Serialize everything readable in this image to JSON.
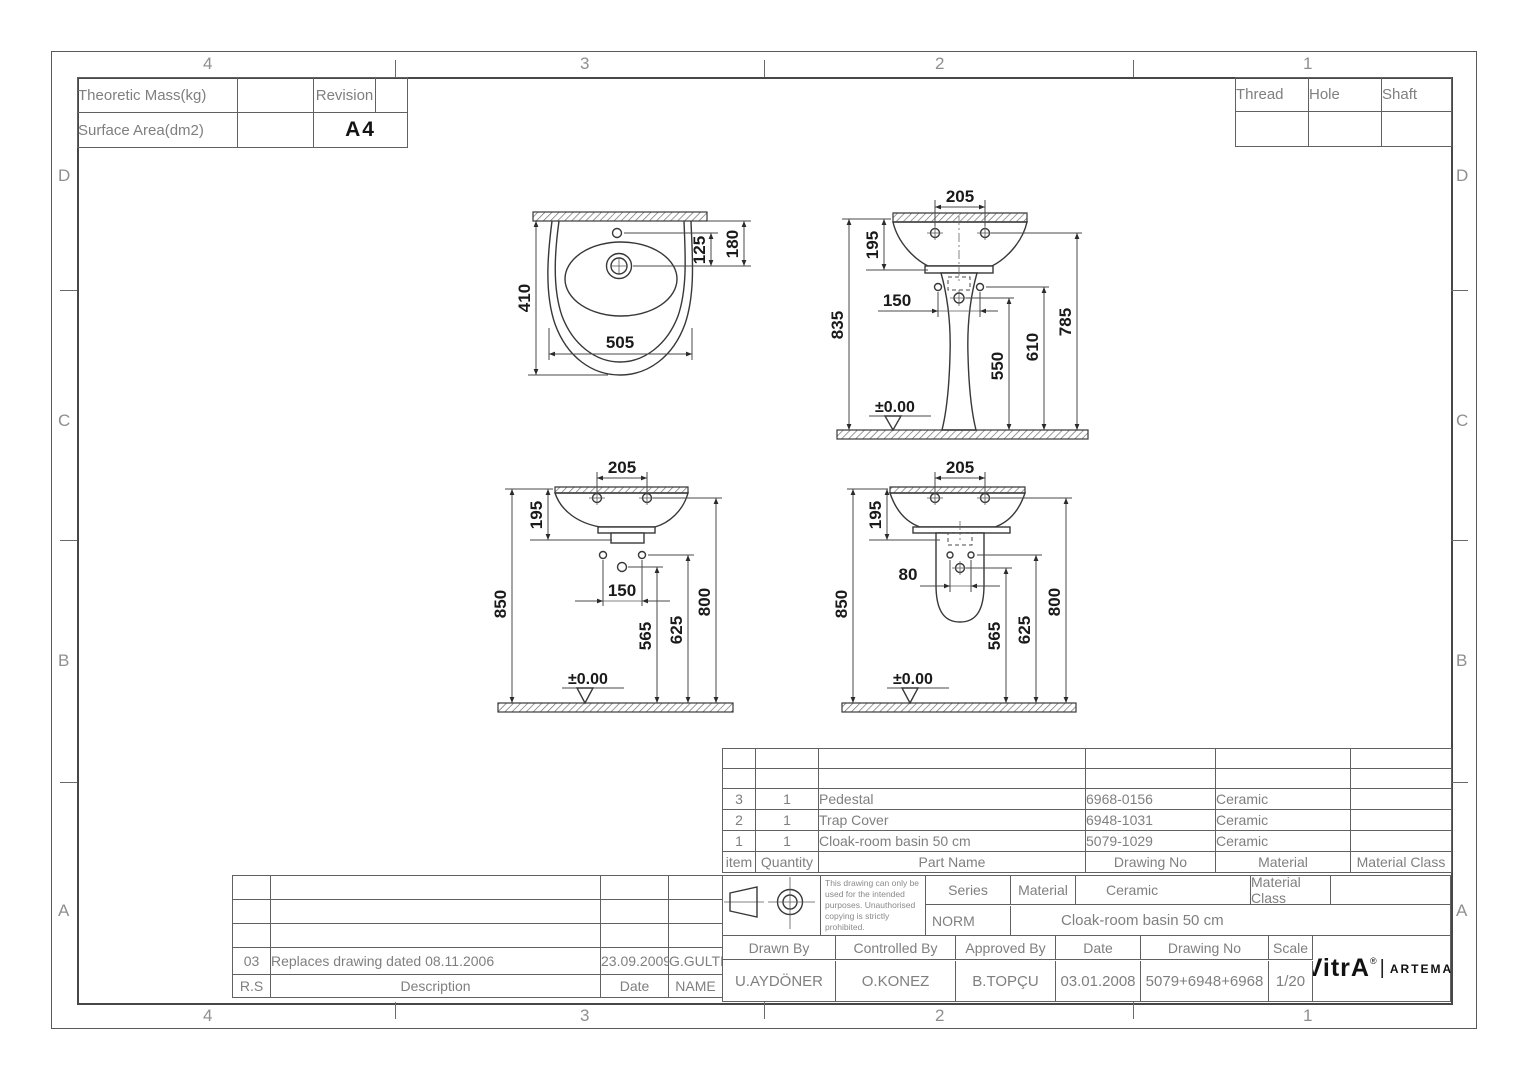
{
  "sheet": {
    "zone_cols": [
      "4",
      "3",
      "2",
      "1"
    ],
    "zone_rows": [
      "D",
      "C",
      "B",
      "A"
    ]
  },
  "colors": {
    "line": "#3f3f3f",
    "cad_text": "#7f7f7f",
    "dim_text": "#1a1a1a"
  },
  "info_table": {
    "theoretic_mass_label": "Theoretic Mass(kg)",
    "surface_area_label": "Surface Area(dm2)",
    "revision_label": "Revision",
    "format": "A4"
  },
  "fit_table": {
    "thread": "Thread",
    "hole": "Hole",
    "shaft": "Shaft"
  },
  "views": {
    "plan": {
      "d410": "410",
      "d505": "505",
      "d125": "125",
      "d180": "180"
    },
    "front": {
      "d205": "205",
      "d195": "195",
      "d835": "835",
      "d150": "150",
      "d550": "550",
      "d610": "610",
      "d785": "785",
      "datum": "±0.00"
    },
    "side_wall": {
      "d205": "205",
      "d195": "195",
      "d850": "850",
      "d150": "150",
      "d565": "565",
      "d625": "625",
      "d800": "800",
      "datum": "±0.00"
    },
    "side_trap": {
      "d205": "205",
      "d195": "195",
      "d850": "850",
      "d80": "80",
      "d565": "565",
      "d625": "625",
      "d800": "800",
      "datum": "±0.00"
    }
  },
  "parts_table": {
    "headers": {
      "item": "item",
      "quantity": "Quantity",
      "part_name": "Part Name",
      "drawing_no": "Drawing No",
      "material": "Material",
      "material_class": "Material Class"
    },
    "rows": [
      {
        "item": "3",
        "quantity": "1",
        "part_name": "Pedestal",
        "drawing_no": "6968-0156",
        "material": "Ceramic",
        "material_class": ""
      },
      {
        "item": "2",
        "quantity": "1",
        "part_name": "Trap Cover",
        "drawing_no": "6948-1031",
        "material": "Ceramic",
        "material_class": ""
      },
      {
        "item": "1",
        "quantity": "1",
        "part_name": "Cloak-room basin 50 cm",
        "drawing_no": "5079-1029",
        "material": "Ceramic",
        "material_class": ""
      }
    ]
  },
  "title_block": {
    "disclaimer": "This drawing can only be used for the intended purposes. Unauthorised copying is strictly prohibited.",
    "series_label": "Series",
    "material_label": "Material",
    "material_value": "Ceramic",
    "material_class_label": "Material Class",
    "norm_label": "NORM",
    "product_name": "Cloak-room basin 50 cm",
    "drawn_by_label": "Drawn By",
    "drawn_by": "U.AYDÖNER",
    "controlled_by_label": "Controlled By",
    "controlled_by": "O.KONEZ",
    "approved_by_label": "Approved By",
    "approved_by": "B.TOPÇU",
    "date_label": "Date",
    "date": "03.01.2008",
    "drawing_no_label": "Drawing No",
    "drawing_no": "5079+6948+6968",
    "scale_label": "Scale",
    "scale": "1/20",
    "brand_primary": "VitrA",
    "brand_divider": "|",
    "brand_secondary": "ARTEMA",
    "reg": "®"
  },
  "revision_table": {
    "rows": [
      {
        "rev": "03",
        "description": "Replaces drawing dated 08.11.2006",
        "date": "23.09.2009",
        "name": "G.GULTER"
      }
    ],
    "footer": {
      "rev": "R.S",
      "description": "Description",
      "date": "Date",
      "name": "NAME"
    }
  }
}
